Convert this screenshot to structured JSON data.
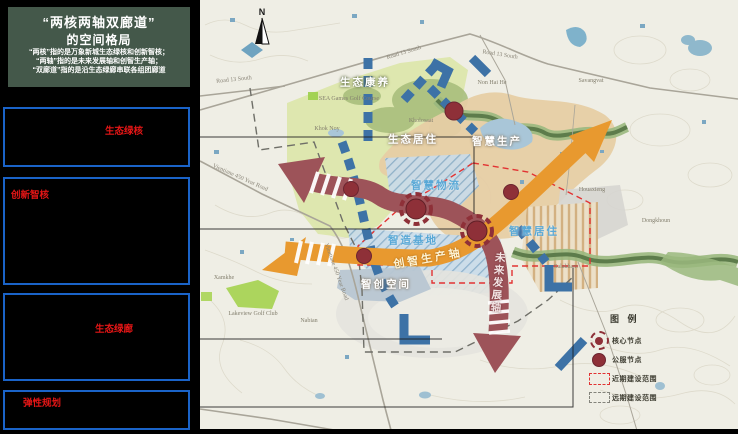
{
  "sidebar": {
    "title_line1": "“两核两轴双廊道”",
    "title_line2": "的空间格局",
    "subtitle_lines": [
      "“两核”指的是万象新城生态绿核和创新智核；",
      "“两轴”指的是未来发展轴和创智生产轴；",
      "“双廊道”指的是沿生态绿廊串联各组团廊道"
    ],
    "boxes": [
      {
        "label": "生态绿核"
      },
      {
        "label": "创新智核"
      },
      {
        "label": "生态绿廊"
      },
      {
        "label": "弹性规划"
      }
    ]
  },
  "map": {
    "north_label": "N",
    "areas": {
      "eco_wellness": "生态康养",
      "eco_living": "生态居住",
      "smart_production": "智慧生产",
      "smart_logistics": "智慧物流",
      "smart_base": "智造基地",
      "smart_living": "智慧居住",
      "smart_space": "智创空间"
    },
    "axes": {
      "production_axis": "创智生产轴",
      "future_axis": "未来发展轴"
    },
    "places": {
      "khok_noy": "Khok Noy",
      "kholosaat": "Kholosaat",
      "sea_golf": "SEA Games Golf Course",
      "non_hai_he": "Non Hai He",
      "savangvat": "Savangvat",
      "houaxieng": "Houaxieng",
      "dongkhoun": "Dongkhoun",
      "salakham": "Salakham",
      "xamkhe": "Xamkhe",
      "lakeview": "Lakeview Golf Club",
      "nabian": "Nabian"
    },
    "roads": {
      "road13": "Road 13 South",
      "year450": "Vientiane 450 Year Road"
    },
    "legend": {
      "title": "图 例",
      "items": [
        {
          "label": "核心节点"
        },
        {
          "label": "公服节点"
        },
        {
          "label": "近期建设范围"
        },
        {
          "label": "远期建设范围"
        }
      ]
    },
    "colors": {
      "future_axis": "#9d5359",
      "production_axis": "#e8992f",
      "corridor_arrow": "#3d72a6",
      "node": "#8e3038",
      "near_term_boundary": "#e23333",
      "long_term_boundary": "#6f6f68",
      "title_box": "#44584a",
      "sidebar_border": "#1a63c8",
      "sidebar_label": "#e51616",
      "map_background": "#efeee5"
    }
  }
}
